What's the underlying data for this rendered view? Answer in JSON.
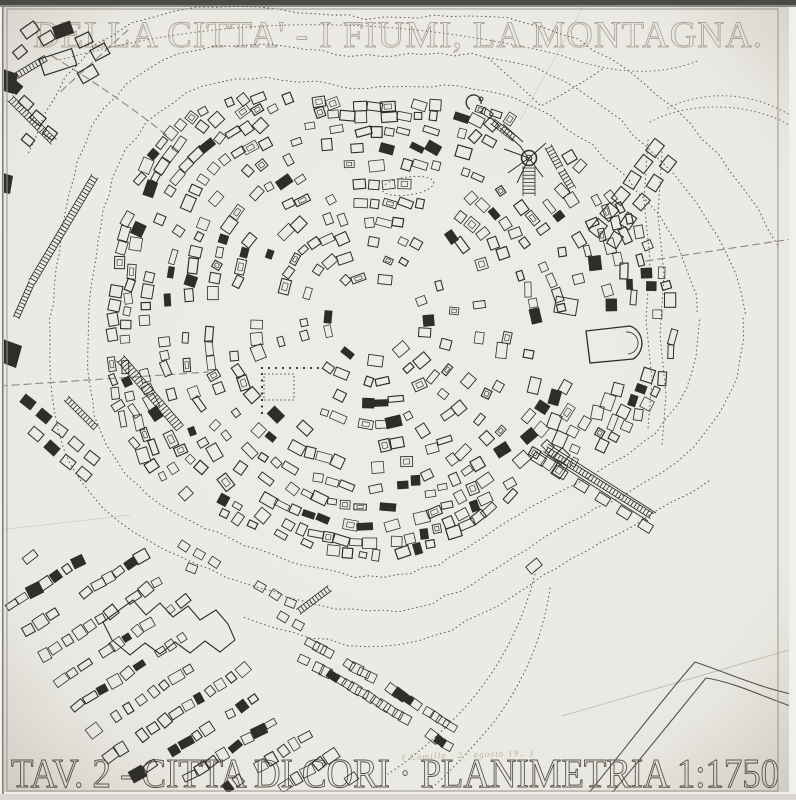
{
  "sheet": {
    "top_title": "DELLA CITTA' - I FIUMI, LA MONTAGNA.",
    "bottom_title": "TAV. 2 - CITTA DI CORI · PLANIMETRIA 1:1750",
    "plate_label": "TAV. 2",
    "subject": "CITTA DI CORI",
    "drawing_type": "PLANIMETRIA",
    "scale": "1:1750",
    "handwritten_note": "( Camillo · 2 · agosto 19.. )"
  },
  "colors": {
    "paper_center": "#edece6",
    "paper_edge": "#e2e0d8",
    "outer_margin": "#f1f0ec",
    "scan_band": "#4b4a47",
    "scan_band2": "#8b8a86",
    "left_edge_line": "#7d7c77",
    "frame_line": "#99968c",
    "ink": "#2f2d29",
    "ink_light": "#56534c",
    "contour_dots": "#5e5b53",
    "dashed_road": "#8f8b81",
    "pencil": "#b4afa4",
    "title_top_stroke": "#a39e92",
    "title_bottom_stroke": "#57544c",
    "note_color": "#b0a996"
  }
}
